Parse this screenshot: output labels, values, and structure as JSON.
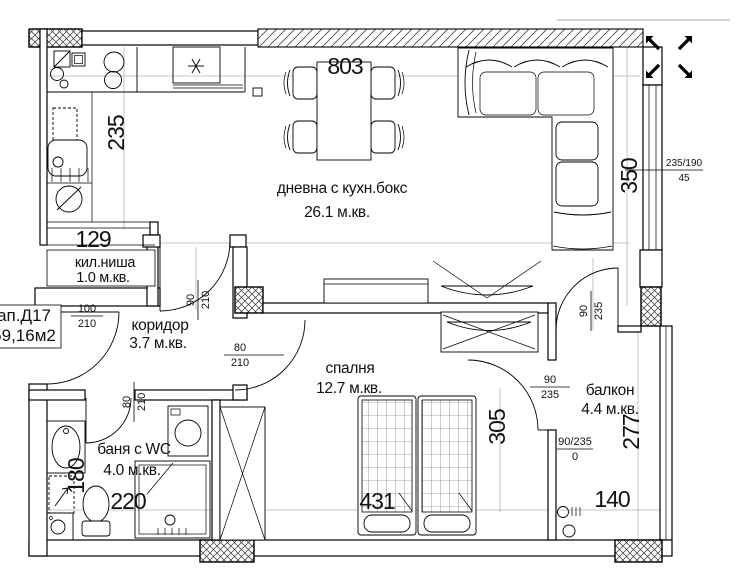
{
  "apartment": {
    "code": "ап.Д17",
    "total_area": "59,16м2"
  },
  "rooms": {
    "living": {
      "name": "дневна с кухн.бокс",
      "area": "26.1 м.кв."
    },
    "niche": {
      "name": "кил.ниша",
      "area": "1.0 м.кв."
    },
    "corridor": {
      "name": "коридор",
      "area": "3.7 м.кв."
    },
    "bedroom": {
      "name": "спалня",
      "area": "12.7 м.кв."
    },
    "bathroom": {
      "name": "баня с WC",
      "area": "4.0 м.кв."
    },
    "balcony": {
      "name": "балкон",
      "area": "4.4 м.кв."
    }
  },
  "dims": {
    "living_width": "803",
    "kitchen_side": "235",
    "niche_width": "129",
    "living_right_side": "350",
    "bedroom_depth": "305",
    "bedroom_width": "431",
    "bathroom_width": "220",
    "bathroom_side": "180",
    "balcony_depth": "277",
    "balcony_width": "140"
  },
  "openings": {
    "entry": {
      "w": "100",
      "h": "210"
    },
    "living_door": {
      "w": "90",
      "h": "210"
    },
    "bedroom_door": {
      "w": "80",
      "h": "210"
    },
    "bathroom_door": {
      "w": "80",
      "h": "210"
    },
    "living_balcony": {
      "w": "90",
      "h": "235"
    },
    "bedroom_balcony": {
      "w": "90",
      "h": "235"
    },
    "balcony_window": {
      "size": "90/235",
      "sill": "0"
    },
    "right_window": {
      "size": "235/190",
      "sill": "45"
    }
  }
}
